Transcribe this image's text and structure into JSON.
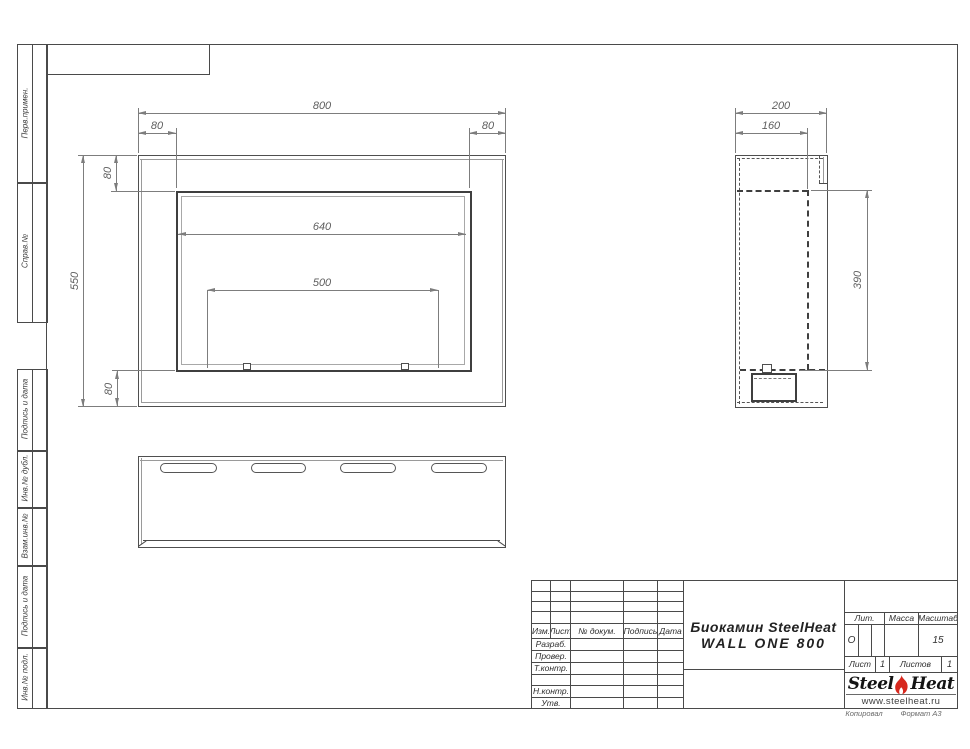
{
  "frame": {
    "margin_boxes": [
      {
        "label": "Перв.примен."
      },
      {
        "label": "Справ.№"
      },
      {
        "label": "Подпись и дата"
      },
      {
        "label": "Инв.№ дубл."
      },
      {
        "label": "Взам.инв.№"
      },
      {
        "label": "Подпись и дата"
      },
      {
        "label": "Инв.№ подл."
      }
    ],
    "footer": {
      "copied_by": "Копировал",
      "format": "Формат А3"
    }
  },
  "drawing": {
    "front_view": {
      "dims": {
        "overall_width": "800",
        "side_inset_left": "80",
        "side_inset_right": "80",
        "top_inset": "80",
        "overall_height": "550",
        "opening_width": "640",
        "mount_span": "500",
        "bottom_inset": "80"
      }
    },
    "side_view": {
      "dims": {
        "overall_depth": "200",
        "inner_depth": "160",
        "opening_height": "390"
      }
    }
  },
  "title_block": {
    "revision_header": {
      "izm": "Изм.",
      "list": "Лист",
      "doc": "№ докум.",
      "sign": "Подпись",
      "date": "Дата"
    },
    "approval_rows": [
      {
        "label": "Разраб."
      },
      {
        "label": "Провер."
      },
      {
        "label": "Т.контр."
      },
      {
        "label": ""
      },
      {
        "label": "Н.контр."
      },
      {
        "label": "Утв."
      }
    ],
    "product": {
      "line1": "Биокамин SteelHeat",
      "line2": "WALL ONE 800"
    },
    "lit": {
      "label": "Лит.",
      "value": "О"
    },
    "mass": {
      "label": "Масса",
      "value": ""
    },
    "scale": {
      "label": "Масштаб",
      "value": "15"
    },
    "sheet": {
      "label": "Лист",
      "value": "1"
    },
    "sheets": {
      "label": "Листов",
      "value": "1"
    },
    "logo": {
      "steel": "Steel",
      "heat": "Heat",
      "url": "www.steelheat.ru"
    }
  },
  "colors": {
    "line": "#4a4a4a",
    "thin_line": "#9a9a9a",
    "dim_line": "#7d7d7d",
    "dim_text": "#5f5f5f",
    "logo_red": "#d7281e"
  }
}
